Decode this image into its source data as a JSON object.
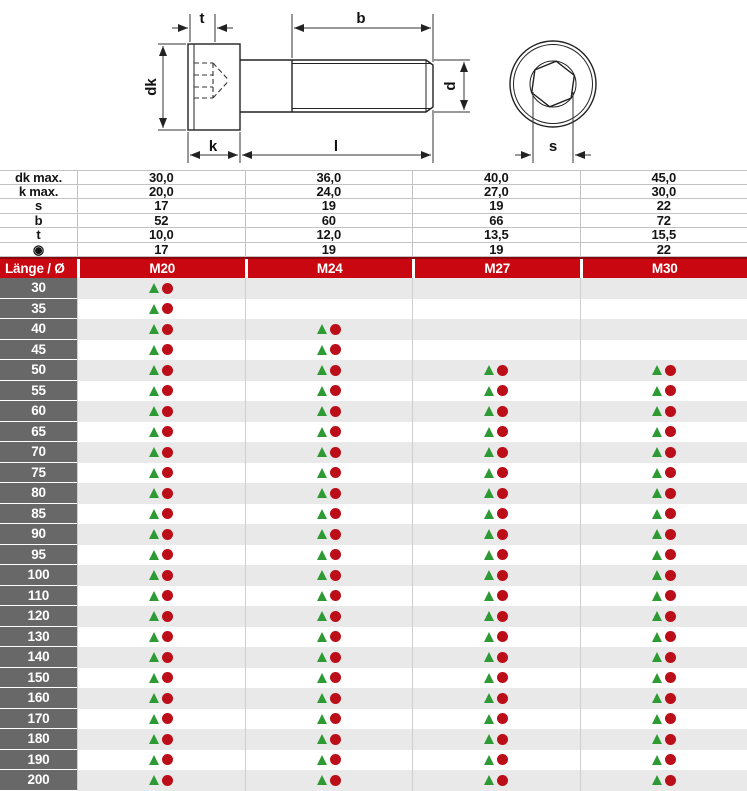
{
  "drawing": {
    "labels": {
      "t": "t",
      "b": "b",
      "dk": "dk",
      "k": "k",
      "l": "l",
      "d": "d",
      "s": "s"
    }
  },
  "spec": {
    "rows": [
      {
        "label": "dk max.",
        "values": [
          "30,0",
          "36,0",
          "40,0",
          "45,0"
        ]
      },
      {
        "label": "k max.",
        "values": [
          "20,0",
          "24,0",
          "27,0",
          "30,0"
        ]
      },
      {
        "label": "s",
        "values": [
          "17",
          "19",
          "19",
          "22"
        ]
      },
      {
        "label": "b",
        "values": [
          "52",
          "60",
          "66",
          "72"
        ]
      },
      {
        "label": "t",
        "values": [
          "10,0",
          "12,0",
          "13,5",
          "15,5"
        ]
      },
      {
        "label": "◉",
        "values": [
          "17",
          "19",
          "19",
          "22"
        ]
      }
    ]
  },
  "table": {
    "header": {
      "label": "Länge / Ø",
      "columns": [
        "M20",
        "M24",
        "M27",
        "M30"
      ]
    },
    "rows": [
      {
        "length": "30",
        "available": [
          1,
          0,
          0,
          0
        ]
      },
      {
        "length": "35",
        "available": [
          1,
          0,
          0,
          0
        ]
      },
      {
        "length": "40",
        "available": [
          1,
          1,
          0,
          0
        ]
      },
      {
        "length": "45",
        "available": [
          1,
          1,
          0,
          0
        ]
      },
      {
        "length": "50",
        "available": [
          1,
          1,
          1,
          1
        ]
      },
      {
        "length": "55",
        "available": [
          1,
          1,
          1,
          1
        ]
      },
      {
        "length": "60",
        "available": [
          1,
          1,
          1,
          1
        ]
      },
      {
        "length": "65",
        "available": [
          1,
          1,
          1,
          1
        ]
      },
      {
        "length": "70",
        "available": [
          1,
          1,
          1,
          1
        ]
      },
      {
        "length": "75",
        "available": [
          1,
          1,
          1,
          1
        ]
      },
      {
        "length": "80",
        "available": [
          1,
          1,
          1,
          1
        ]
      },
      {
        "length": "85",
        "available": [
          1,
          1,
          1,
          1
        ]
      },
      {
        "length": "90",
        "available": [
          1,
          1,
          1,
          1
        ]
      },
      {
        "length": "95",
        "available": [
          1,
          1,
          1,
          1
        ]
      },
      {
        "length": "100",
        "available": [
          1,
          1,
          1,
          1
        ]
      },
      {
        "length": "110",
        "available": [
          1,
          1,
          1,
          1
        ]
      },
      {
        "length": "120",
        "available": [
          1,
          1,
          1,
          1
        ]
      },
      {
        "length": "130",
        "available": [
          1,
          1,
          1,
          1
        ]
      },
      {
        "length": "140",
        "available": [
          1,
          1,
          1,
          1
        ]
      },
      {
        "length": "150",
        "available": [
          1,
          1,
          1,
          1
        ]
      },
      {
        "length": "160",
        "available": [
          1,
          1,
          1,
          1
        ]
      },
      {
        "length": "170",
        "available": [
          1,
          1,
          1,
          1
        ]
      },
      {
        "length": "180",
        "available": [
          1,
          1,
          1,
          1
        ]
      },
      {
        "length": "190",
        "available": [
          1,
          1,
          1,
          1
        ]
      },
      {
        "length": "200",
        "available": [
          1,
          1,
          1,
          1
        ]
      }
    ]
  },
  "colors": {
    "header_red": "#c90711",
    "label_gray": "#686868",
    "row_alt": "#e9e9e9",
    "marker_green": "#2e9a33",
    "marker_red": "#bb0e18",
    "grid_line": "#cfcfcf",
    "spec_line": "#c3c3c3"
  }
}
